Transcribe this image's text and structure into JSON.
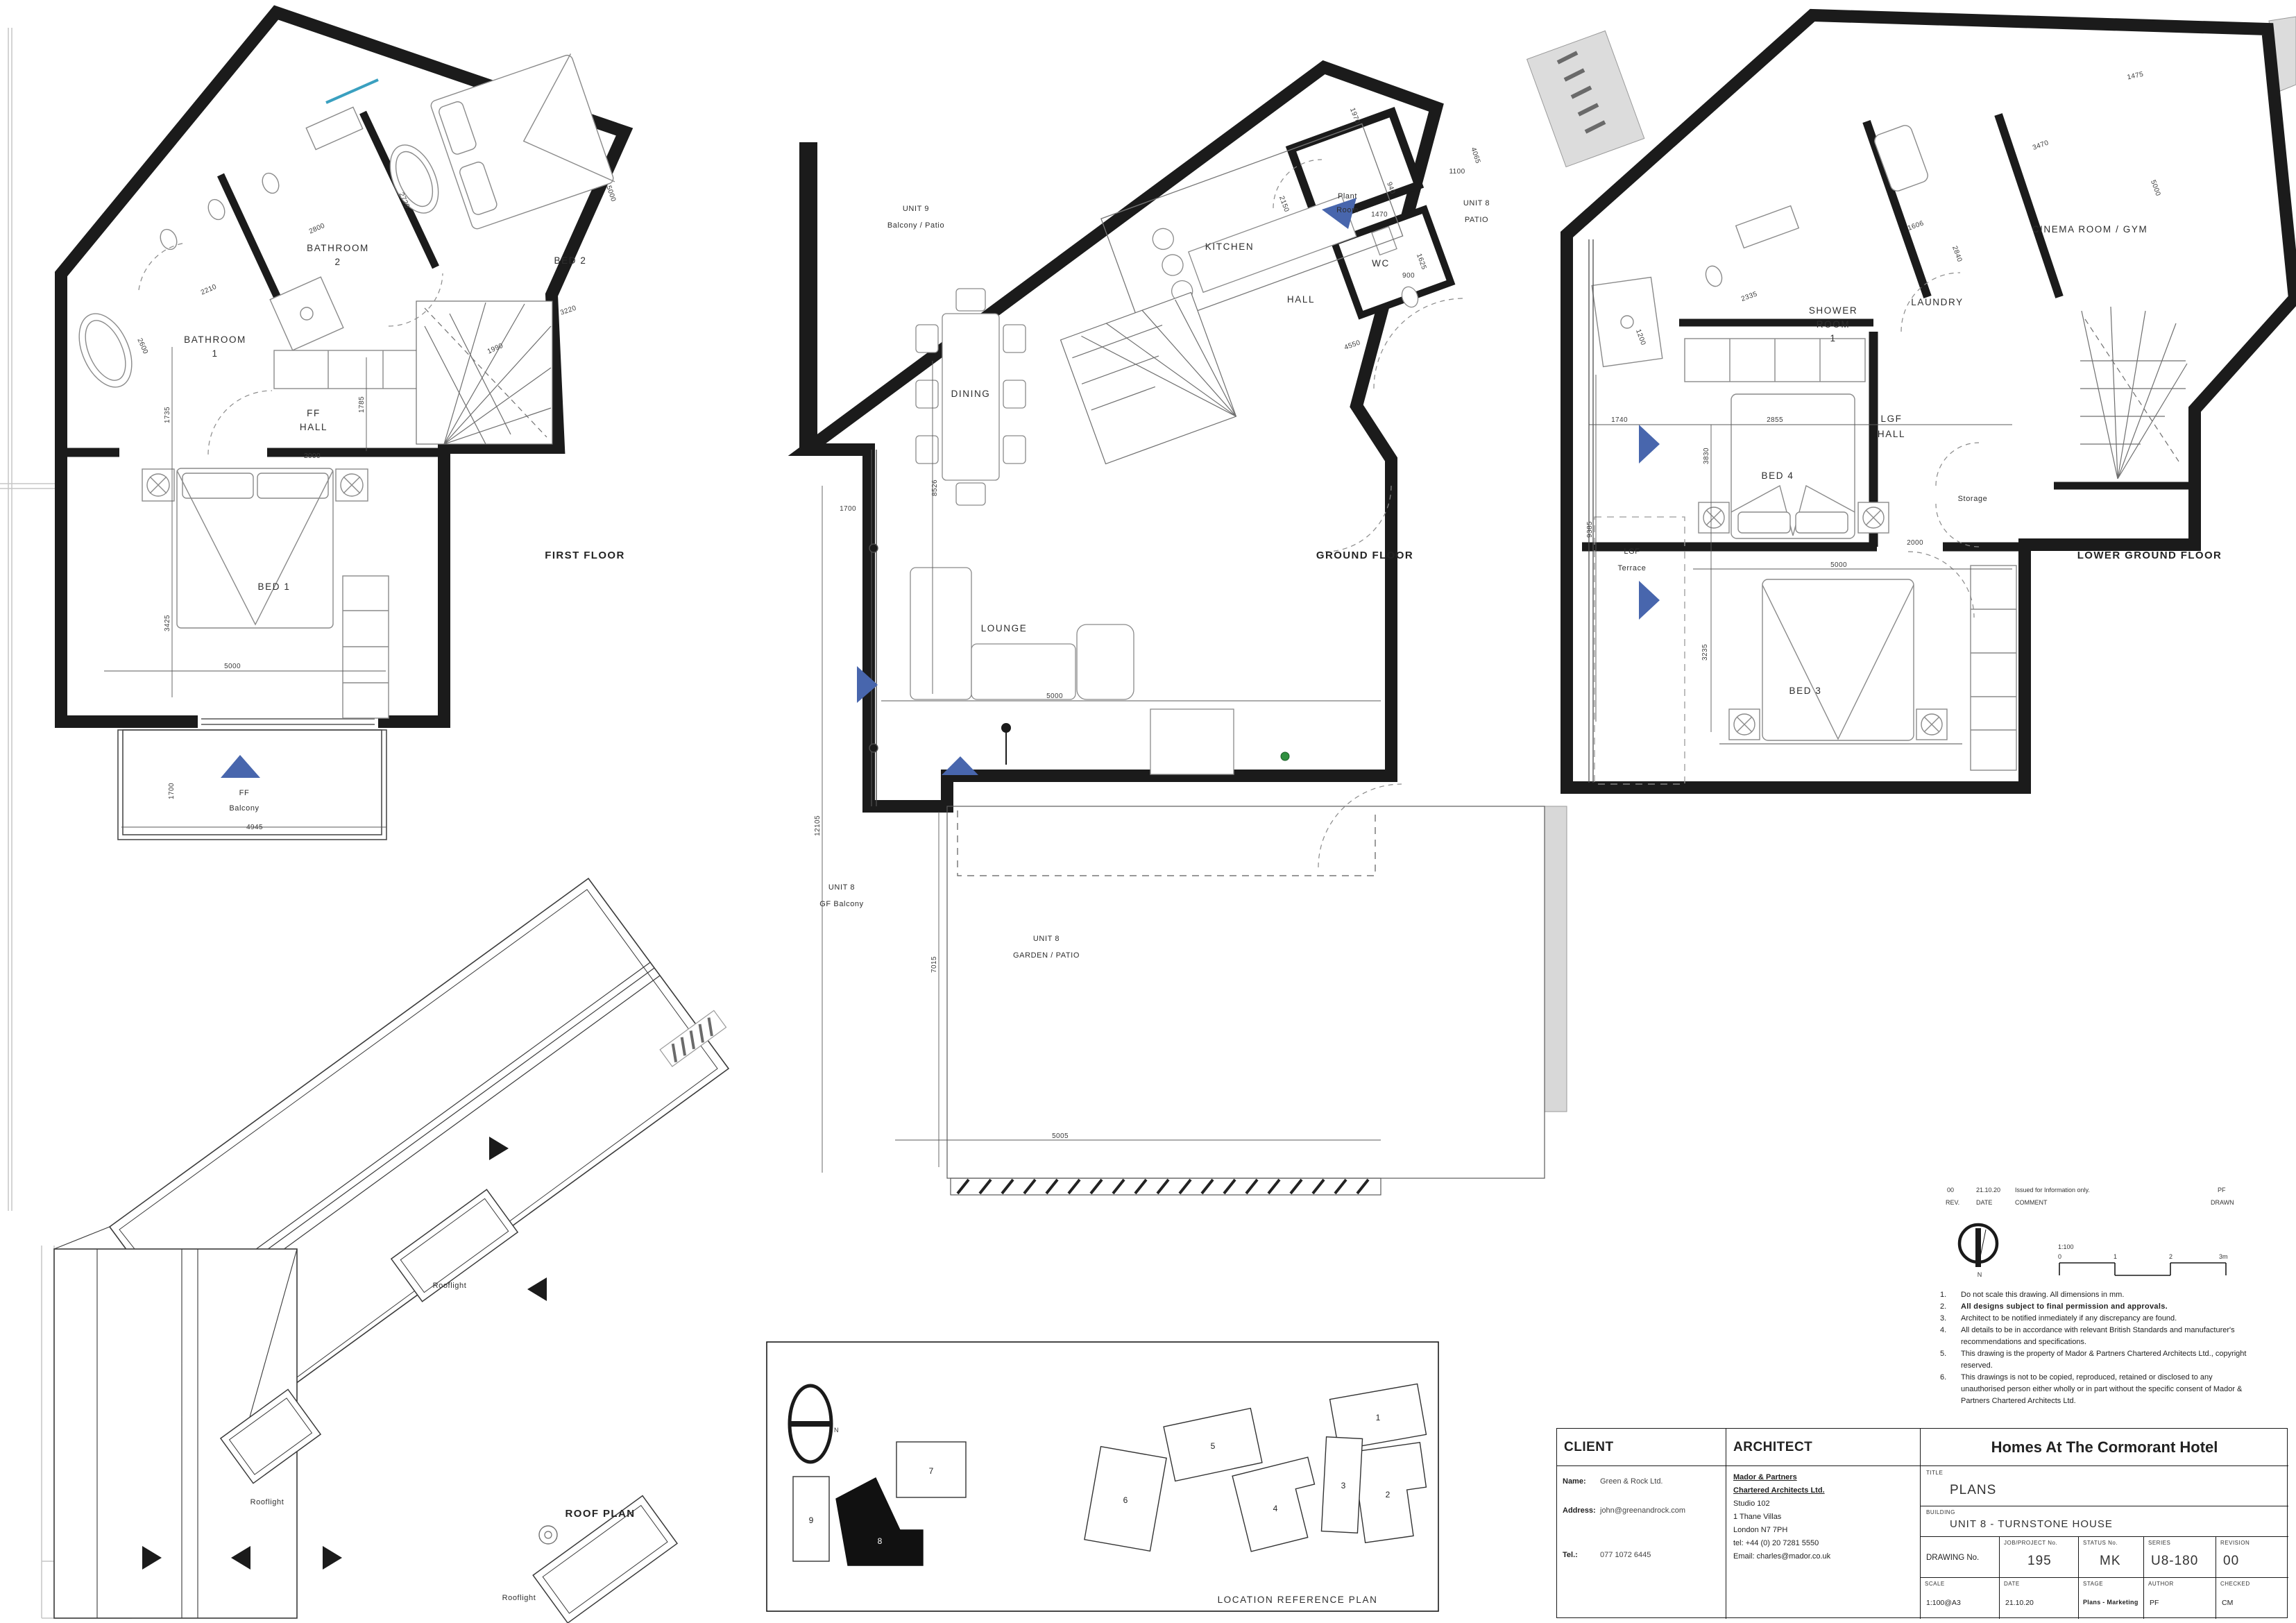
{
  "sheet": {
    "accent_blue": "#4866ad",
    "line_black": "#1b1b1b"
  },
  "plans": {
    "first_floor": {
      "title": "FIRST FLOOR",
      "rooms": {
        "bathroom1": [
          "BATHROOM",
          "1"
        ],
        "bathroom2": [
          "BATHROOM",
          "2"
        ],
        "bed2": "BED 2",
        "ff_hall": [
          "FF",
          "HALL"
        ],
        "bed1": "BED 1",
        "ff_balcony": [
          "FF",
          "Balcony"
        ]
      },
      "dims": [
        "2210",
        "2600",
        "2800",
        "2720",
        "1735",
        "3425",
        "5000",
        "2000",
        "1785",
        "1990",
        "3220",
        "5000",
        "1700",
        "4945"
      ]
    },
    "ground_floor": {
      "title": "GROUND FLOOR",
      "rooms": {
        "unit9": [
          "UNIT 9",
          "Balcony / Patio"
        ],
        "kitchen": "KITCHEN",
        "plant": [
          "Plant",
          "Room"
        ],
        "wc": "WC",
        "hall": "HALL",
        "patio": [
          "UNIT 8",
          "PATIO"
        ],
        "dining": "DINING",
        "lounge": "LOUNGE",
        "gf_balcony": [
          "UNIT 8",
          "GF Balcony"
        ],
        "garden": [
          "UNIT 8",
          "GARDEN / PATIO"
        ]
      },
      "dims": [
        "2150",
        "4550",
        "1970",
        "940",
        "1470",
        "1100",
        "4065",
        "1625",
        "900",
        "8526",
        "1700",
        "5000",
        "12105",
        "7015",
        "5005"
      ]
    },
    "lower_ground": {
      "title": "LOWER GROUND FLOOR",
      "rooms": {
        "shower": [
          "SHOWER",
          "ROOM",
          "1"
        ],
        "laundry": "LAUNDRY",
        "cinema": "CINEMA ROOM / GYM",
        "lgf_hall": [
          "LGF",
          "HALL"
        ],
        "bed4": "BED 4",
        "storage": "Storage",
        "terrace": [
          "LGF",
          "Terrace"
        ],
        "bed3": "BED 3"
      },
      "dims": [
        "1200",
        "2335",
        "1606",
        "2840",
        "1475",
        "3470",
        "5000",
        "1740",
        "2855",
        "3830",
        "2000",
        "9385",
        "3235",
        "5000"
      ]
    },
    "roof": {
      "title": "ROOF PLAN",
      "rooflight": "Rooflight"
    }
  },
  "location_plan": {
    "title": "LOCATION REFERENCE PLAN",
    "buildings": [
      "1",
      "2",
      "3",
      "4",
      "5",
      "6",
      "7",
      "8",
      "9"
    ],
    "north": "N"
  },
  "rev_strip": {
    "rev_value": "00",
    "date_value": "21.10.20",
    "comment_value": "Issued for Information only.",
    "drawn_value": "PF",
    "rev": "REV.",
    "date": "DATE",
    "comment": "COMMENT",
    "drawn": "DRAWN"
  },
  "north_symbol": "N",
  "scale_bar": {
    "ratio": "1:100",
    "t0": "0",
    "t1": "1",
    "t2": "2",
    "t3": "3m"
  },
  "notes": [
    {
      "n": "1.",
      "text": "Do not scale this drawing. All dimensions in mm."
    },
    {
      "n": "2.",
      "text": "All designs subject to final permission and approvals."
    },
    {
      "n": "3.",
      "text": "Architect to be notified inmediately if any discrepancy are found."
    },
    {
      "n": "4.",
      "text": "All details to be in accordance with relevant British Standards and manufacturer's recommendations and specifications."
    },
    {
      "n": "5.",
      "text": "This drawing is the property of Mador & Partners Chartered Architects Ltd., copyright reserved."
    },
    {
      "n": "6.",
      "text": "This drawings is not to be copied, reproduced, retained or disclosed to any unauthorised person either wholly or in part without the specific consent of Mador & Partners Chartered Architects Ltd."
    }
  ],
  "title_block": {
    "client_header": "CLIENT",
    "architect_header": "ARCHITECT",
    "project_title": "Homes At The Cormorant Hotel",
    "name_label": "Name:",
    "name_value": "Green & Rock Ltd.",
    "address_label": "Address:",
    "address_value": "john@greenandrock.com",
    "tel_label": "Tel.:",
    "tel_value": "077 1072 6445",
    "architect_lines": [
      "Mador & Partners",
      "Chartered Architects Ltd.",
      "Studio 102",
      "1 Thane Villas",
      "London N7 7PH",
      "tel: +44 (0) 20 7281 5550",
      "Email: charles@mador.co.uk"
    ],
    "title_label": "TITLE",
    "title_value": "PLANS",
    "building_label": "BUILDING",
    "building_value": "UNIT 8 - TURNSTONE HOUSE",
    "drawing_no_label": "DRAWING No.",
    "job_label": "JOB/PROJECT No.",
    "job_value": "195",
    "status_label": "STATUS No.",
    "status_value": "MK",
    "series_label": "SERIES",
    "series_value": "U8-180",
    "revision_label": "REVISION",
    "revision_value": "00",
    "scale_label": "SCALE",
    "scale_value": "1:100@A3",
    "date_label": "DATE",
    "date_value": "21.10.20",
    "stage_label": "STAGE",
    "stage_value": "Plans - Marketing",
    "author_label": "AUTHOR",
    "author_value": "PF",
    "checked_label": "CHECKED",
    "checked_value": "CM"
  }
}
